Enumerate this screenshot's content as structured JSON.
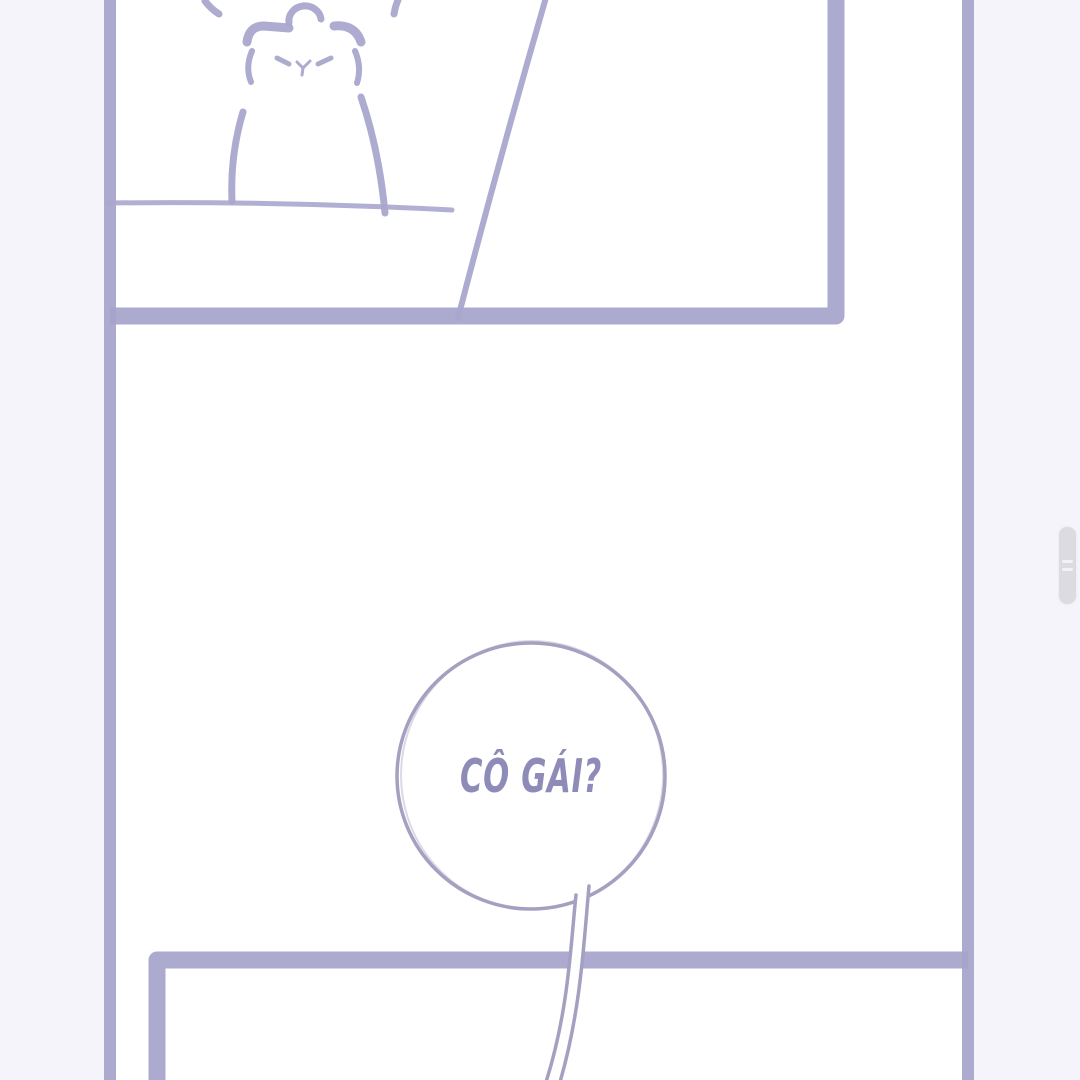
{
  "app": {
    "view": "comic reader page"
  },
  "comic": {
    "speech_bubble": {
      "text": "CÔ GÁI?"
    },
    "panels": [
      {
        "name": "top-panel",
        "content": "sketched bear character sitting behind a table line, wall diagonal line"
      },
      {
        "name": "bottom-panel",
        "content": "empty panel, speech bubble tail crosses its top border"
      }
    ]
  },
  "icons": {
    "scrollbar_grip": "grip-lines-icon"
  },
  "scrollbar": {
    "thumb_visible": true
  },
  "colors": {
    "background": "#F5F4FA",
    "page": "#FFFFFF",
    "panel_border": "#A6A3CB",
    "line_art": "#A9A6CE",
    "bubble_stroke": "#A3A0C0",
    "bubble_text": "#8E8BB8",
    "scrollbar_thumb": "#DCDBDF",
    "scrollbar_grip": "#F2F1F7"
  }
}
